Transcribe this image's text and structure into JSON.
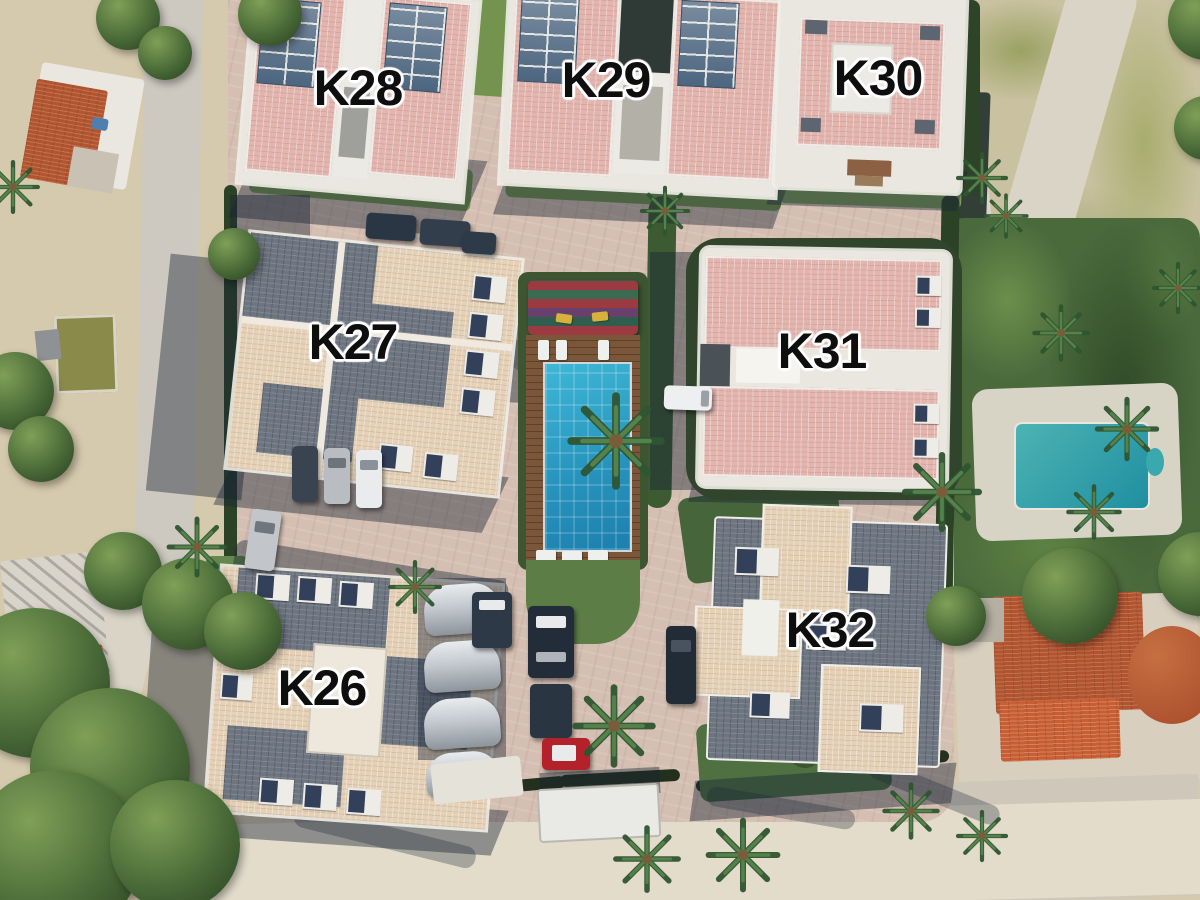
{
  "site": {
    "name": "Aerial site plan of residential complex",
    "buildings": {
      "k26": {
        "label": "K26"
      },
      "k27": {
        "label": "K27"
      },
      "k28": {
        "label": "K28"
      },
      "k29": {
        "label": "K29"
      },
      "k30": {
        "label": "K30"
      },
      "k31": {
        "label": "K31"
      },
      "k32": {
        "label": "K32"
      }
    },
    "palette": {
      "roof_pink": "#e2b6af",
      "roof_cream": "#e5d1b8",
      "roof_slate": "#6d7581",
      "terracotta_roof": "#b2542e",
      "paving": "#d5bfb2",
      "pool_water": "#2795bd",
      "neighbor_pool": "#3aa9ad",
      "grass": "#74934f",
      "hedge_dark": "#2c4226",
      "sand": "#d6caae",
      "label_color": "#0e0e0e",
      "label_outline": "#ffffff"
    }
  }
}
